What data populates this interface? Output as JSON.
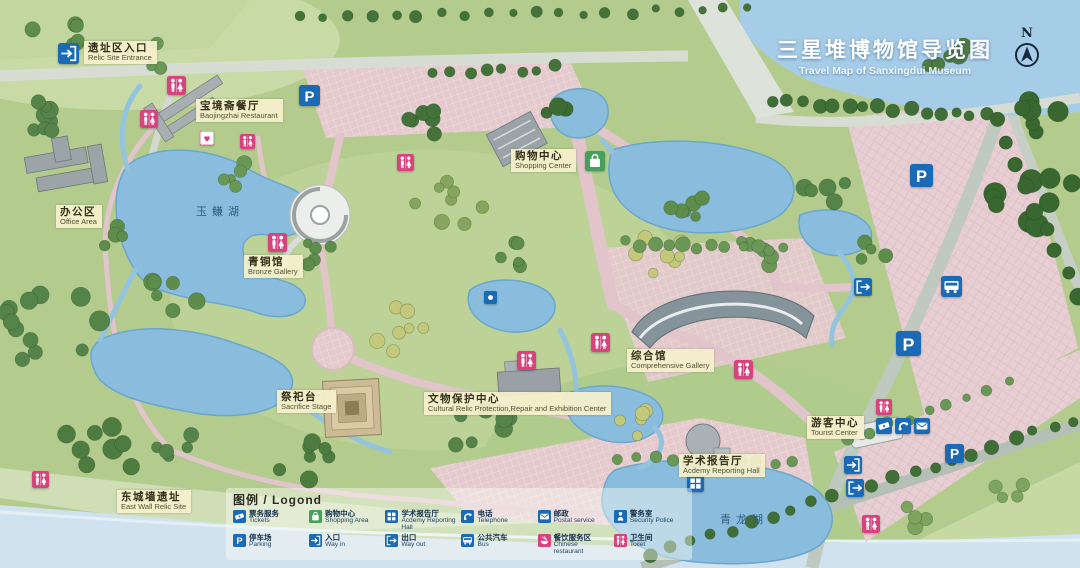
{
  "title": {
    "zh": "三星堆博物馆导览图",
    "en": "Travel Map of Sanxingdui Museum"
  },
  "compass": {
    "label": "N"
  },
  "glyphs": {
    "parking": "P"
  },
  "colors": {
    "icon_blue": "#1a6ab5",
    "icon_pink": "#d8437e",
    "icon_green": "#46a05a",
    "label_bg": "#f4efcd",
    "water": "#8abddd",
    "title_text": "#ffffff"
  },
  "map": {
    "places": [
      {
        "id": "relic-site-entrance",
        "zh": "遗址区入口",
        "en": "Relic Site Entrance",
        "x": 84,
        "y": 41
      },
      {
        "id": "baojingzhai-restaurant",
        "zh": "宝境斋餐厅",
        "en": "Baojingzhai Restaurant",
        "x": 196,
        "y": 99
      },
      {
        "id": "office-area",
        "zh": "办公区",
        "en": "Office Area",
        "x": 56,
        "y": 205
      },
      {
        "id": "bronze-gallery",
        "zh": "青铜馆",
        "en": "Bronze Gallery",
        "x": 244,
        "y": 255
      },
      {
        "id": "shopping-center",
        "zh": "购物中心",
        "en": "Shopping Center",
        "x": 511,
        "y": 149
      },
      {
        "id": "comprehensive-gallery",
        "zh": "综合馆",
        "en": "Comprehensive Gallery",
        "x": 627,
        "y": 349
      },
      {
        "id": "sacrifice-stage",
        "zh": "祭祀台",
        "en": "Sacrifice Stage",
        "x": 277,
        "y": 390
      },
      {
        "id": "cultural-relic-center",
        "zh": "文物保护中心",
        "en": "Cultural Relic Protection,Repair and Exhibition Center",
        "x": 424,
        "y": 392
      },
      {
        "id": "academy-reporting-hall",
        "zh": "学术报告厅",
        "en": "Acdemy Reporting Hall",
        "x": 679,
        "y": 454
      },
      {
        "id": "tourist-center",
        "zh": "游客中心",
        "en": "Tourist Center",
        "x": 807,
        "y": 416
      },
      {
        "id": "east-wall-relic-site",
        "zh": "东城墙遗址",
        "en": "East Wall Relic Site",
        "x": 117,
        "y": 490
      }
    ],
    "lake_labels": [
      {
        "name": "玉鳒湖",
        "x": 196,
        "y": 203
      },
      {
        "name": "青龙湖",
        "x": 720,
        "y": 511
      }
    ],
    "icons": [
      {
        "type": "wayin",
        "x": 58,
        "y": 43,
        "s": 21
      },
      {
        "type": "toilet",
        "x": 167,
        "y": 76,
        "s": 19
      },
      {
        "type": "toilet",
        "x": 140,
        "y": 110,
        "s": 18
      },
      {
        "type": "parking",
        "x": 299,
        "y": 85,
        "s": 21
      },
      {
        "type": "firstaid",
        "x": 200,
        "y": 131,
        "s": 14
      },
      {
        "type": "toilet",
        "x": 240,
        "y": 134,
        "s": 15
      },
      {
        "type": "toilet",
        "x": 268,
        "y": 233,
        "s": 19
      },
      {
        "type": "toilet",
        "x": 397,
        "y": 154,
        "s": 17
      },
      {
        "type": "shopping",
        "x": 585,
        "y": 151,
        "s": 20
      },
      {
        "type": "landmark",
        "x": 484,
        "y": 291,
        "s": 13
      },
      {
        "type": "toilet",
        "x": 517,
        "y": 351,
        "s": 19
      },
      {
        "type": "toilet",
        "x": 591,
        "y": 333,
        "s": 19
      },
      {
        "type": "toilet",
        "x": 734,
        "y": 360,
        "s": 19
      },
      {
        "type": "wayout",
        "x": 854,
        "y": 278,
        "s": 18
      },
      {
        "type": "bus",
        "x": 941,
        "y": 276,
        "s": 21
      },
      {
        "type": "parking",
        "x": 910,
        "y": 164,
        "s": 23
      },
      {
        "type": "parking",
        "x": 896,
        "y": 331,
        "s": 25
      },
      {
        "type": "toilet",
        "x": 876,
        "y": 399,
        "s": 16
      },
      {
        "type": "ticket",
        "x": 876,
        "y": 418,
        "s": 16
      },
      {
        "type": "telephone",
        "x": 895,
        "y": 418,
        "s": 16
      },
      {
        "type": "postal",
        "x": 914,
        "y": 418,
        "s": 16
      },
      {
        "type": "wayin",
        "x": 844,
        "y": 456,
        "s": 18
      },
      {
        "type": "wayout",
        "x": 846,
        "y": 479,
        "s": 18
      },
      {
        "type": "academy",
        "x": 687,
        "y": 475,
        "s": 17
      },
      {
        "type": "parking",
        "x": 945,
        "y": 444,
        "s": 19
      },
      {
        "type": "toilet",
        "x": 862,
        "y": 515,
        "s": 18
      },
      {
        "type": "toilet",
        "x": 32,
        "y": 471,
        "s": 17
      }
    ]
  },
  "legend": {
    "title": "图例 / Logond",
    "items": [
      {
        "zh": "票务服务",
        "en": "Tickets",
        "icon": "ticket"
      },
      {
        "zh": "购物中心",
        "en": "Shopping Area",
        "icon": "shopping"
      },
      {
        "zh": "学术报告厅",
        "en": "Acdemy Reporting Hall",
        "icon": "academy"
      },
      {
        "zh": "电话",
        "en": "Telephone",
        "icon": "telephone"
      },
      {
        "zh": "邮政",
        "en": "Postal service",
        "icon": "postal"
      },
      {
        "zh": "警务室",
        "en": "Security Police",
        "icon": "police"
      },
      {
        "zh": "停车场",
        "en": "Parking",
        "icon": "parking"
      },
      {
        "zh": "入口",
        "en": "Way in",
        "icon": "wayin"
      },
      {
        "zh": "出口",
        "en": "Way out",
        "icon": "wayout"
      },
      {
        "zh": "公共汽车",
        "en": "Bus",
        "icon": "bus"
      },
      {
        "zh": "餐饮服务区",
        "en": "Chinese restaurant",
        "icon": "restaurant"
      },
      {
        "zh": "卫生间",
        "en": "Toilet",
        "icon": "toilet"
      }
    ]
  }
}
